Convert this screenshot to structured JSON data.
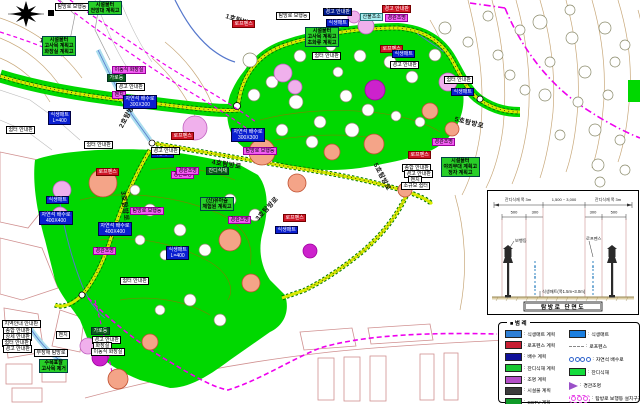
{
  "colors": {
    "grass": "#00d800",
    "trail_inner": "#d8ea00",
    "trail_edge": "#007700",
    "boundary_magenta": "#ee00ee",
    "stream_blue": "#5577cc",
    "contour_tan": "#c8a87a",
    "parcel_pink": "#d09090"
  },
  "map": {
    "trail_labels": [
      {
        "text": "1호탐방로",
        "x": 40,
        "y": 34,
        "rot": 14
      },
      {
        "text": "1호탐방로",
        "x": 226,
        "y": 10,
        "rot": 18
      },
      {
        "text": "2호탐방로",
        "x": 120,
        "y": 122,
        "rot": -62
      },
      {
        "text": "3호탐방로",
        "x": 124,
        "y": 186,
        "rot": 83
      },
      {
        "text": "4호탐방로",
        "x": 212,
        "y": 156,
        "rot": 9
      },
      {
        "text": "3호탐방로",
        "x": 256,
        "y": 214,
        "rot": -47
      },
      {
        "text": "5호탐방로",
        "x": 455,
        "y": 113,
        "rot": 14
      },
      {
        "text": "5호탐방로",
        "x": 376,
        "y": 158,
        "rot": 62
      }
    ],
    "labels": [
      {
        "t": "탐방로 보행등",
        "x": 55,
        "y": 3,
        "s": "w"
      },
      {
        "t": "시설물터\n전망대 계획고",
        "x": 88,
        "y": 1,
        "s": "g"
      },
      {
        "t": "시설물터\n고사목 계획고\n화장실 계획고",
        "x": 42,
        "y": 36,
        "s": "g"
      },
      {
        "t": "탐방로 보행등",
        "x": 276,
        "y": 12,
        "s": "w"
      },
      {
        "t": "경고 안내판",
        "x": 323,
        "y": 8,
        "s": "n"
      },
      {
        "t": "경고 안내판",
        "x": 382,
        "y": 5,
        "s": "r"
      },
      {
        "t": "경관조명",
        "x": 385,
        "y": 14,
        "s": "m"
      },
      {
        "t": "산불초소",
        "x": 360,
        "y": 13,
        "s": "c"
      },
      {
        "t": "로프펜스",
        "x": 232,
        "y": 20,
        "s": "r"
      },
      {
        "t": "식생매트",
        "x": 326,
        "y": 19,
        "s": "b"
      },
      {
        "t": "시설물터\n고사목 계획고\n초화류 계획고",
        "x": 305,
        "y": 27,
        "s": "g"
      },
      {
        "t": "쉼터 안내판",
        "x": 312,
        "y": 52,
        "s": "w"
      },
      {
        "t": "로프펜스",
        "x": 380,
        "y": 45,
        "s": "r"
      },
      {
        "t": "식생매트",
        "x": 392,
        "y": 50,
        "s": "b"
      },
      {
        "t": "경고 안내판",
        "x": 390,
        "y": 61,
        "s": "w"
      },
      {
        "t": "쉼터 안내판",
        "x": 444,
        "y": 76,
        "s": "w"
      },
      {
        "t": "식생매트",
        "x": 451,
        "y": 88,
        "s": "b"
      },
      {
        "t": "이동식 화장실",
        "x": 112,
        "y": 66,
        "s": "m"
      },
      {
        "t": "가로등",
        "x": 107,
        "y": 74,
        "s": "dg"
      },
      {
        "t": "경고 안내판",
        "x": 116,
        "y": 83,
        "s": "w"
      },
      {
        "t": "벤치",
        "x": 112,
        "y": 91,
        "s": "m"
      },
      {
        "t": "자연석 배수로\n300X300",
        "x": 123,
        "y": 95,
        "s": "b"
      },
      {
        "t": "식생매트\nL=400",
        "x": 48,
        "y": 111,
        "s": "b"
      },
      {
        "t": "쉼터 안내판",
        "x": 6,
        "y": 126,
        "s": "w"
      },
      {
        "t": "쉼터 안내판",
        "x": 84,
        "y": 141,
        "s": "w"
      },
      {
        "t": "식생매트",
        "x": 151,
        "y": 150,
        "s": "b"
      },
      {
        "t": "로프펜스",
        "x": 96,
        "y": 168,
        "s": "r"
      },
      {
        "t": "경관조명",
        "x": 171,
        "y": 171,
        "s": "m"
      },
      {
        "t": "식생매트",
        "x": 46,
        "y": 196,
        "s": "b"
      },
      {
        "t": "자연석 배수로\n400X400",
        "x": 39,
        "y": 211,
        "s": "b"
      },
      {
        "t": "탐방로 보행등",
        "x": 130,
        "y": 207,
        "s": "m"
      },
      {
        "t": "자연석 배수로\n400X400",
        "x": 98,
        "y": 222,
        "s": "b"
      },
      {
        "t": "경관조명",
        "x": 93,
        "y": 247,
        "s": "m"
      },
      {
        "t": "식생매트\nL=400",
        "x": 166,
        "y": 246,
        "s": "b"
      },
      {
        "t": "로프펜스",
        "x": 171,
        "y": 132,
        "s": "r"
      },
      {
        "t": "자연석 배수로\n300X300",
        "x": 231,
        "y": 128,
        "s": "b"
      },
      {
        "t": "경고 안내판",
        "x": 151,
        "y": 147,
        "s": "w"
      },
      {
        "t": "탐방로 보행등",
        "x": 243,
        "y": 147,
        "s": "m"
      },
      {
        "t": "경관조명",
        "x": 176,
        "y": 167,
        "s": "m"
      },
      {
        "t": "잔디식재",
        "x": 206,
        "y": 167,
        "s": "dg"
      },
      {
        "t": "(신)유아숲\n체험원 계획고",
        "x": 200,
        "y": 197,
        "s": "g"
      },
      {
        "t": "경관조명",
        "x": 228,
        "y": 216,
        "s": "m"
      },
      {
        "t": "로프펜스",
        "x": 283,
        "y": 214,
        "s": "r"
      },
      {
        "t": "식생매트",
        "x": 275,
        "y": 226,
        "s": "b"
      },
      {
        "t": "쉼터 안내판",
        "x": 120,
        "y": 277,
        "s": "w"
      },
      {
        "t": "경관조명",
        "x": 432,
        "y": 138,
        "s": "m"
      },
      {
        "t": "로프펜스",
        "x": 408,
        "y": 151,
        "s": "r"
      },
      {
        "t": "시설물터\n야외무대 계획고\n정자 계획고",
        "x": 441,
        "y": 157,
        "s": "g"
      },
      {
        "t": "종합 안내판",
        "x": 402,
        "y": 164,
        "s": "w"
      },
      {
        "t": "경고 안내판",
        "x": 404,
        "y": 170,
        "s": "w"
      },
      {
        "t": "벤치",
        "x": 408,
        "y": 176,
        "s": "w"
      },
      {
        "t": "소규모 쉼터",
        "x": 401,
        "y": 182,
        "s": "w"
      },
      {
        "t": "지역안내 안내판",
        "x": 2,
        "y": 320,
        "s": "w"
      },
      {
        "t": "종합 안내판",
        "x": 3,
        "y": 327,
        "s": "w"
      },
      {
        "t": "상세 안내판",
        "x": 3,
        "y": 333,
        "s": "w"
      },
      {
        "t": "쉼터 안내판",
        "x": 2,
        "y": 339,
        "s": "w"
      },
      {
        "t": "경고 안내판",
        "x": 3,
        "y": 345,
        "s": "w"
      },
      {
        "t": "벤치",
        "x": 56,
        "y": 331,
        "s": "w"
      },
      {
        "t": "무장애 탐방로",
        "x": 34,
        "y": 349,
        "s": "w"
      },
      {
        "t": "가로등",
        "x": 91,
        "y": 327,
        "s": "dg"
      },
      {
        "t": "경고 안내판",
        "x": 92,
        "y": 336,
        "s": "w"
      },
      {
        "t": "화장실",
        "x": 93,
        "y": 342,
        "s": "w"
      },
      {
        "t": "이동식 화장실",
        "x": 91,
        "y": 348,
        "s": "w"
      },
      {
        "t": "수목표찰\n고사목 제거",
        "x": 39,
        "y": 359,
        "s": "g"
      }
    ],
    "trees": [
      [
        250,
        60,
        7,
        "w"
      ],
      [
        272,
        82,
        6,
        "w"
      ],
      [
        296,
        102,
        7,
        "w"
      ],
      [
        320,
        122,
        6,
        "w"
      ],
      [
        346,
        96,
        6,
        "w"
      ],
      [
        300,
        56,
        6,
        "w"
      ],
      [
        331,
        46,
        5,
        "w"
      ],
      [
        360,
        56,
        6,
        "w"
      ],
      [
        390,
        62,
        6,
        "w"
      ],
      [
        412,
        77,
        6,
        "w"
      ],
      [
        352,
        130,
        7,
        "w"
      ],
      [
        312,
        142,
        6,
        "w"
      ],
      [
        282,
        130,
        6,
        "w"
      ],
      [
        420,
        122,
        5,
        "w"
      ],
      [
        396,
        116,
        5,
        "w"
      ],
      [
        368,
        110,
        6,
        "w"
      ],
      [
        254,
        95,
        6,
        "w"
      ],
      [
        338,
        72,
        5,
        "w"
      ],
      [
        262,
        152,
        13,
        "s"
      ],
      [
        297,
        183,
        9,
        "s"
      ],
      [
        332,
        152,
        8,
        "s"
      ],
      [
        374,
        144,
        10,
        "s"
      ],
      [
        430,
        111,
        8,
        "s"
      ],
      [
        452,
        129,
        7,
        "s"
      ],
      [
        405,
        190,
        7,
        "s"
      ],
      [
        230,
        240,
        11,
        "s"
      ],
      [
        251,
        283,
        9,
        "s"
      ],
      [
        103,
        183,
        14,
        "s"
      ],
      [
        118,
        379,
        10,
        "s"
      ],
      [
        150,
        342,
        8,
        "s"
      ],
      [
        195,
        128,
        12,
        "p"
      ],
      [
        283,
        73,
        9,
        "p"
      ],
      [
        295,
        87,
        7,
        "p"
      ],
      [
        366,
        26,
        8,
        "p"
      ],
      [
        354,
        17,
        6,
        "p"
      ],
      [
        448,
        82,
        9,
        "p"
      ],
      [
        88,
        346,
        8,
        "p"
      ],
      [
        62,
        190,
        9,
        "p"
      ],
      [
        60,
        215,
        8,
        "p"
      ],
      [
        375,
        90,
        10,
        "v"
      ],
      [
        310,
        251,
        7,
        "v"
      ],
      [
        100,
        358,
        8,
        "v"
      ],
      [
        540,
        22,
        7,
        "w"
      ],
      [
        572,
        38,
        6,
        "w"
      ],
      [
        605,
        28,
        6,
        "w"
      ],
      [
        625,
        45,
        5,
        "w"
      ],
      [
        550,
        62,
        5,
        "w"
      ],
      [
        585,
        72,
        6,
        "w"
      ],
      [
        615,
        62,
        5,
        "w"
      ],
      [
        545,
        95,
        6,
        "w"
      ],
      [
        578,
        102,
        5,
        "w"
      ],
      [
        608,
        95,
        5,
        "w"
      ],
      [
        595,
        130,
        6,
        "w"
      ],
      [
        620,
        140,
        5,
        "w"
      ],
      [
        560,
        135,
        5,
        "w"
      ],
      [
        598,
        165,
        6,
        "w"
      ],
      [
        625,
        170,
        5,
        "w"
      ],
      [
        445,
        28,
        6,
        "w"
      ],
      [
        468,
        42,
        5,
        "w"
      ],
      [
        488,
        16,
        5,
        "w"
      ],
      [
        498,
        55,
        5,
        "w"
      ],
      [
        510,
        75,
        5,
        "w"
      ],
      [
        525,
        90,
        5,
        "w"
      ],
      [
        435,
        55,
        6,
        "w"
      ],
      [
        600,
        182,
        5,
        "w"
      ],
      [
        570,
        10,
        5,
        "w"
      ],
      [
        520,
        30,
        5,
        "w"
      ],
      [
        150,
        210,
        6,
        "w"
      ],
      [
        180,
        230,
        6,
        "w"
      ],
      [
        205,
        250,
        6,
        "w"
      ],
      [
        165,
        255,
        5,
        "w"
      ],
      [
        140,
        240,
        5,
        "w"
      ],
      [
        190,
        300,
        6,
        "w"
      ],
      [
        160,
        310,
        5,
        "w"
      ],
      [
        220,
        320,
        6,
        "w"
      ],
      [
        135,
        190,
        5,
        "w"
      ],
      [
        230,
        200,
        6,
        "w"
      ],
      [
        255,
        215,
        6,
        "w"
      ]
    ]
  },
  "section": {
    "title": "탐방로 단면도",
    "dim_l": "잔디식재 폭 3m",
    "dim_c": "1,500 ~ 3,000",
    "dim_r": "잔디식재 폭 3m",
    "d500a": "500",
    "d300a": "300",
    "d300b": "300",
    "d500b": "500",
    "lamp": "보행등",
    "rope": "로프펜스",
    "note": "식생매트(폭1.5m~3.0m)"
  },
  "legend": {
    "title": "■ 범 례",
    "separator": ":",
    "left": [
      {
        "c": "#2e7fd6",
        "l": "식생매트 계획"
      },
      {
        "c": "#c81e32",
        "l": "로프펜스 계획"
      },
      {
        "c": "#101099",
        "l": "배수 계획"
      },
      {
        "c": "#18c832",
        "l": "잔디식재 계획"
      },
      {
        "c": "#b44fc8",
        "l": "조명 계획"
      },
      {
        "c": "#3c3c3c",
        "l": "시설물 계획"
      },
      {
        "c": "#0f9a28",
        "l": "CCTV 계획"
      }
    ],
    "right": [
      {
        "k": "rect",
        "c": "#1b7fe0",
        "l": "식생매트"
      },
      {
        "k": "dash",
        "c": "#888888",
        "l": "로프펜스"
      },
      {
        "k": "chain",
        "c": "#3366cc",
        "l": "자연석 배수로"
      },
      {
        "k": "rect",
        "c": "#14dc3c",
        "l": "잔디식재"
      },
      {
        "k": "arrow",
        "c": "#9a50c8",
        "l": "경관조명"
      },
      {
        "k": "dotchain",
        "c": "#e84fe8",
        "l": "탐방로 보행등 설치구간"
      }
    ]
  }
}
